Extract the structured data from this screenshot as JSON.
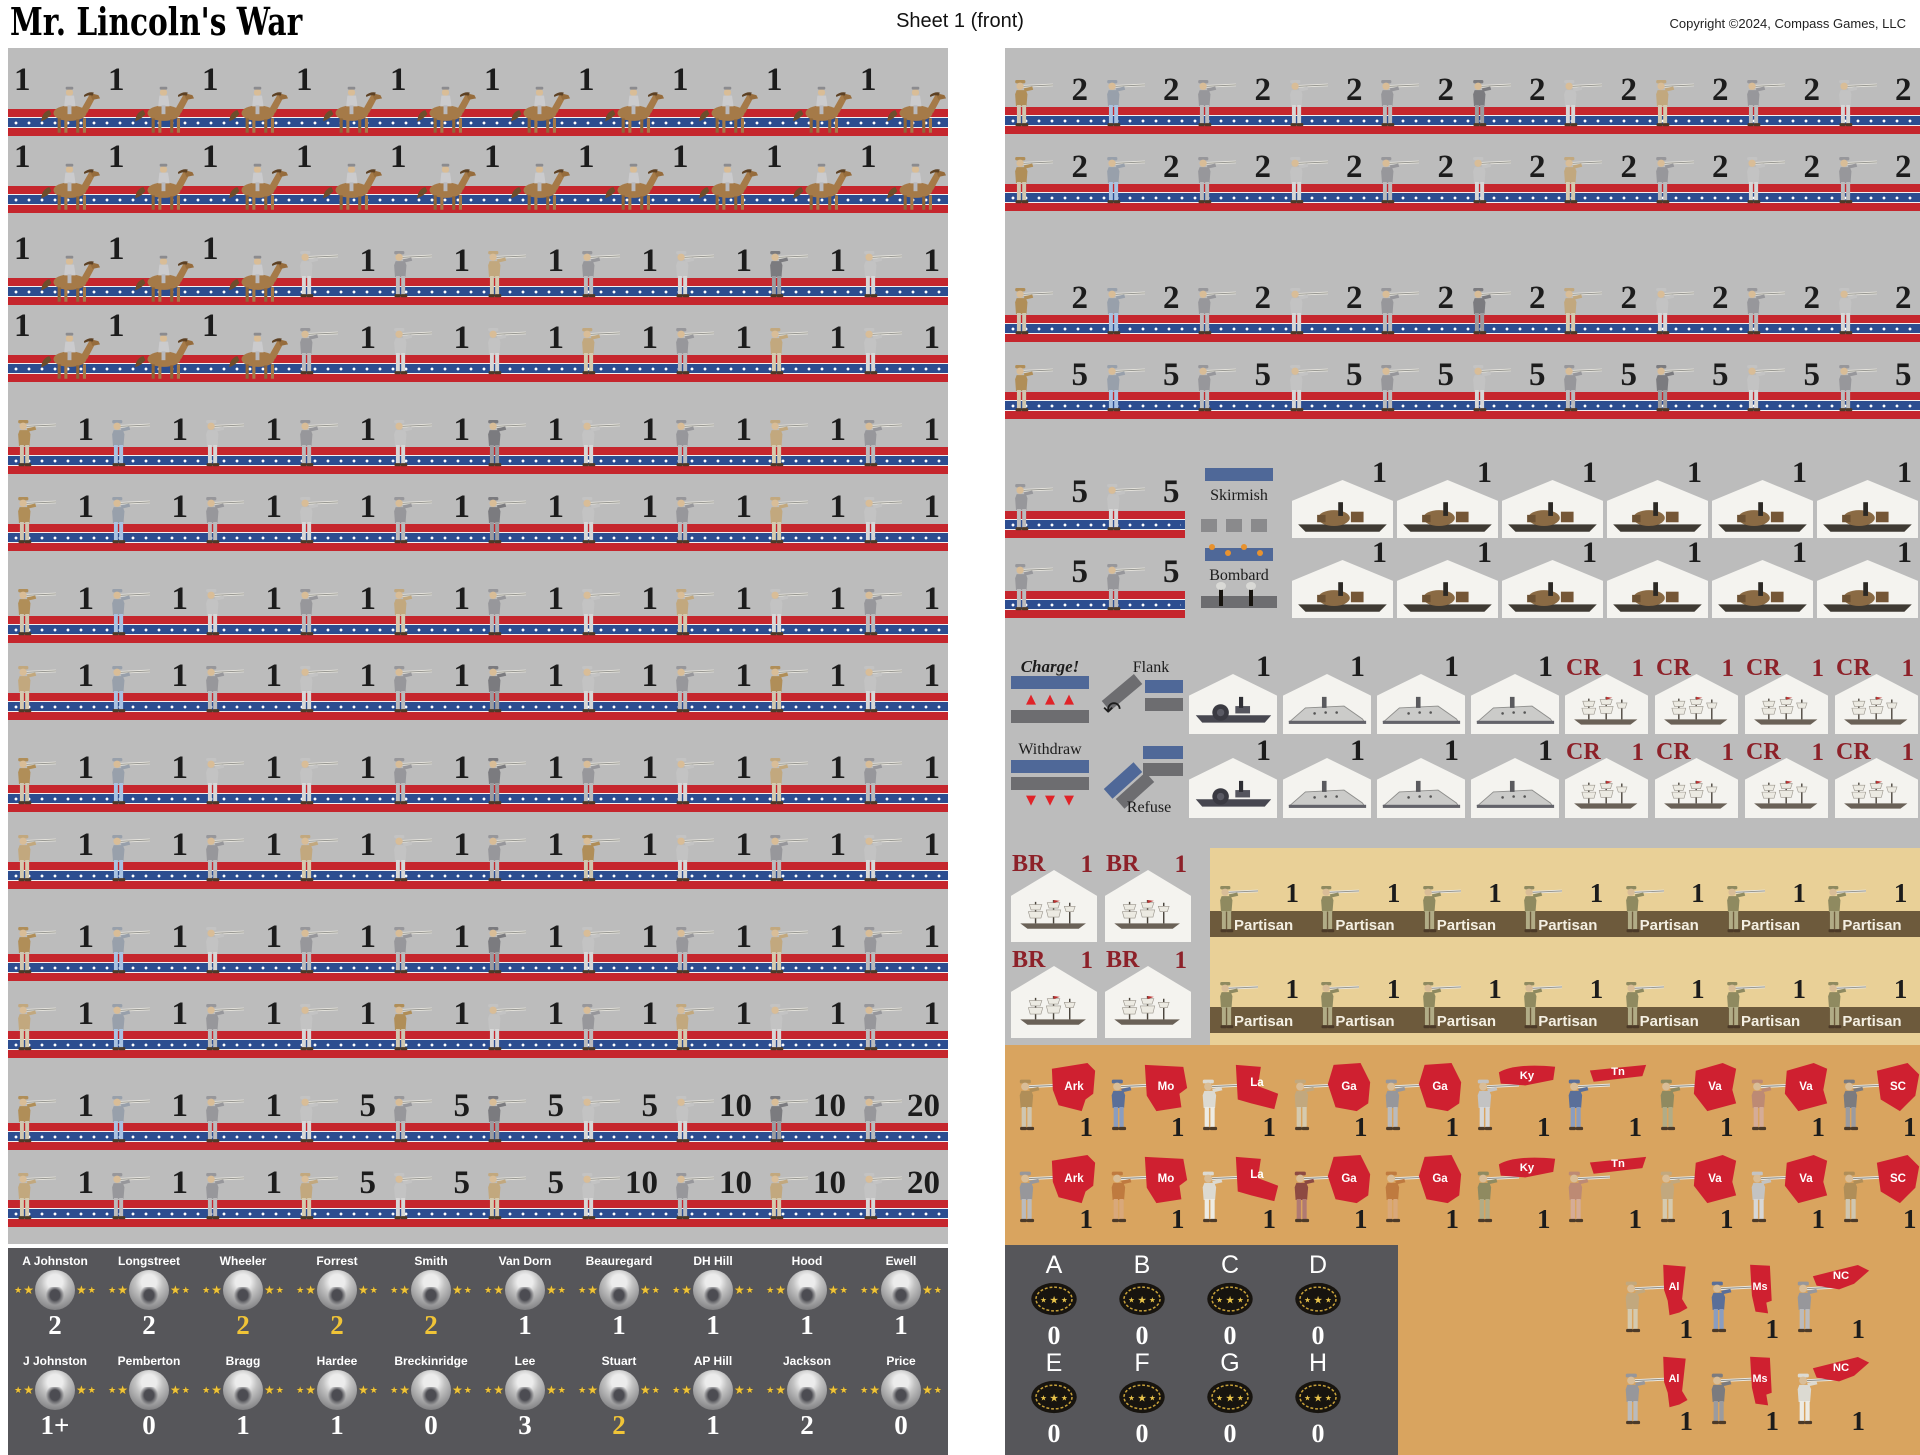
{
  "header": {
    "title": "Mr. Lincoln's War",
    "sheet_label": "Sheet 1 (front)",
    "copyright": "Copyright ©2024, Compass Games, LLC"
  },
  "colors": {
    "panel_gray": "#bcbcbc",
    "dark_panel": "#56565a",
    "orange_panel": "#d9a45f",
    "partisan_panel": "#e9d097",
    "stripe_red": "#c5262d",
    "stripe_blue": "#2c4d90",
    "maroon": "#8d2129",
    "gold_star": "#f0c437",
    "partisan_band": "#6d5a3c",
    "state_red": "#cf2030"
  },
  "labels": {
    "skirmish": "Skirmish",
    "bombard": "Bombard",
    "charge": "Charge!",
    "flank": "Flank",
    "withdraw": "Withdraw",
    "refuse": "Refuse",
    "partisan": "Partisan",
    "cr": "CR",
    "br": "BR"
  },
  "left_panel": {
    "rows": [
      {
        "kind": "cavalry",
        "values": [
          "1",
          "1",
          "1",
          "1",
          "1",
          "1",
          "1",
          "1",
          "1",
          "1"
        ],
        "uniforms": []
      },
      {
        "kind": "cavalry",
        "values": [
          "1",
          "1",
          "1",
          "1",
          "1",
          "1",
          "1",
          "1",
          "1",
          "1"
        ],
        "uniforms": []
      },
      {
        "kind": "mixed",
        "values": [
          "1",
          "1",
          "1",
          "1",
          "1",
          "1",
          "1",
          "1",
          "1",
          "1"
        ],
        "uniforms": [
          "l",
          "g",
          "u",
          "g",
          "l",
          "d",
          "l"
        ]
      },
      {
        "kind": "mixed",
        "values": [
          "1",
          "1",
          "1",
          "1",
          "1",
          "1",
          "1",
          "1",
          "1",
          "1"
        ],
        "uniforms": [
          "g",
          "l",
          "l",
          "u",
          "g",
          "u",
          "l"
        ]
      },
      {
        "kind": "infantry",
        "values": [
          "1",
          "1",
          "1",
          "1",
          "1",
          "1",
          "1",
          "1",
          "1",
          "1"
        ],
        "uniforms": [
          "t",
          "b",
          "l",
          "g",
          "l",
          "d",
          "l",
          "g",
          "u",
          "g"
        ]
      },
      {
        "kind": "infantry",
        "values": [
          "1",
          "1",
          "1",
          "1",
          "1",
          "1",
          "1",
          "1",
          "1",
          "1"
        ],
        "uniforms": [
          "t",
          "b",
          "g",
          "l",
          "g",
          "d",
          "l",
          "g",
          "u",
          "l"
        ]
      },
      {
        "kind": "infantry",
        "values": [
          "1",
          "1",
          "1",
          "1",
          "1",
          "1",
          "1",
          "1",
          "1",
          "1"
        ],
        "uniforms": [
          "t",
          "b",
          "l",
          "g",
          "u",
          "g",
          "l",
          "u",
          "l",
          "g"
        ]
      },
      {
        "kind": "infantry",
        "values": [
          "1",
          "1",
          "1",
          "1",
          "1",
          "1",
          "1",
          "1",
          "1",
          "1"
        ],
        "uniforms": [
          "u",
          "b",
          "g",
          "l",
          "g",
          "d",
          "l",
          "g",
          "t",
          "l"
        ]
      },
      {
        "kind": "infantry",
        "values": [
          "1",
          "1",
          "1",
          "1",
          "1",
          "1",
          "1",
          "1",
          "1",
          "1"
        ],
        "uniforms": [
          "t",
          "b",
          "l",
          "l",
          "g",
          "d",
          "g",
          "l",
          "u",
          "g"
        ]
      },
      {
        "kind": "infantry",
        "values": [
          "1",
          "1",
          "1",
          "1",
          "1",
          "1",
          "1",
          "1",
          "1",
          "1"
        ],
        "uniforms": [
          "u",
          "b",
          "g",
          "u",
          "l",
          "g",
          "t",
          "l",
          "g",
          "l"
        ]
      },
      {
        "kind": "infantry",
        "values": [
          "1",
          "1",
          "1",
          "1",
          "1",
          "1",
          "1",
          "1",
          "1",
          "1"
        ],
        "uniforms": [
          "t",
          "b",
          "l",
          "g",
          "g",
          "d",
          "l",
          "g",
          "u",
          "g"
        ]
      },
      {
        "kind": "infantry",
        "values": [
          "1",
          "1",
          "1",
          "1",
          "1",
          "1",
          "1",
          "1",
          "1",
          "1"
        ],
        "uniforms": [
          "u",
          "b",
          "g",
          "l",
          "t",
          "l",
          "g",
          "u",
          "l",
          "g"
        ]
      },
      {
        "kind": "infantry",
        "values": [
          "1",
          "1",
          "1",
          "5",
          "5",
          "5",
          "5",
          "10",
          "10",
          "20"
        ],
        "uniforms": [
          "t",
          "b",
          "g",
          "l",
          "g",
          "d",
          "l",
          "l",
          "d",
          "g"
        ]
      },
      {
        "kind": "infantry",
        "values": [
          "1",
          "1",
          "1",
          "5",
          "5",
          "5",
          "10",
          "10",
          "10",
          "20"
        ],
        "uniforms": [
          "u",
          "g",
          "g",
          "u",
          "l",
          "u",
          "l",
          "g",
          "u",
          "l"
        ]
      }
    ]
  },
  "leaders": {
    "rows": [
      [
        {
          "name": "A Johnston",
          "value": "2",
          "gold": false
        },
        {
          "name": "Longstreet",
          "value": "2",
          "gold": false
        },
        {
          "name": "Wheeler",
          "value": "2",
          "gold": true
        },
        {
          "name": "Forrest",
          "value": "2",
          "gold": true
        },
        {
          "name": "Smith",
          "value": "2",
          "gold": true
        },
        {
          "name": "Van Dorn",
          "value": "1",
          "gold": false
        },
        {
          "name": "Beauregard",
          "value": "1",
          "gold": false
        },
        {
          "name": "DH Hill",
          "value": "1",
          "gold": false
        },
        {
          "name": "Hood",
          "value": "1",
          "gold": false
        },
        {
          "name": "Ewell",
          "value": "1",
          "gold": false
        }
      ],
      [
        {
          "name": "J Johnston",
          "value": "1+",
          "gold": false
        },
        {
          "name": "Pemberton",
          "value": "0",
          "gold": false
        },
        {
          "name": "Bragg",
          "value": "1",
          "gold": false
        },
        {
          "name": "Hardee",
          "value": "1",
          "gold": false
        },
        {
          "name": "Breckinridge",
          "value": "0",
          "gold": false
        },
        {
          "name": "Lee",
          "value": "3",
          "gold": false
        },
        {
          "name": "Stuart",
          "value": "2",
          "gold": true
        },
        {
          "name": "AP Hill",
          "value": "1",
          "gold": false
        },
        {
          "name": "Jackson",
          "value": "2",
          "gold": false
        },
        {
          "name": "Price",
          "value": "0",
          "gold": false
        }
      ]
    ]
  },
  "right_panel": {
    "infantry_rows": [
      {
        "values": [
          "2",
          "2",
          "2",
          "2",
          "2",
          "2",
          "2",
          "2",
          "2",
          "2"
        ],
        "uniforms": [
          "t",
          "b",
          "g",
          "l",
          "g",
          "d",
          "l",
          "u",
          "g",
          "l"
        ]
      },
      {
        "values": [
          "2",
          "2",
          "2",
          "2",
          "2",
          "2",
          "2",
          "2",
          "2",
          "2"
        ],
        "uniforms": [
          "t",
          "b",
          "g",
          "l",
          "g",
          "l",
          "u",
          "g",
          "l",
          "g"
        ]
      },
      {
        "values": [
          "2",
          "2",
          "2",
          "2",
          "2",
          "2",
          "2",
          "2",
          "2",
          "2"
        ],
        "uniforms": [
          "t",
          "b",
          "g",
          "l",
          "g",
          "d",
          "u",
          "l",
          "g",
          "l"
        ]
      },
      {
        "values": [
          "5",
          "5",
          "5",
          "5",
          "5",
          "5",
          "5",
          "5",
          "5",
          "5"
        ],
        "uniforms": [
          "t",
          "b",
          "g",
          "l",
          "g",
          "l",
          "g",
          "d",
          "l",
          "g"
        ]
      }
    ],
    "gunboat_rows": [
      {
        "infantry_values": [
          "5",
          "5"
        ],
        "infantry_uniforms": [
          "g",
          "l"
        ],
        "tactic": "skirmish",
        "boat_values": [
          "1",
          "1",
          "1",
          "1",
          "1",
          "1"
        ]
      },
      {
        "infantry_values": [
          "5",
          "5"
        ],
        "infantry_uniforms": [
          "g",
          "g"
        ],
        "tactic": "bombard",
        "boat_values": [
          "1",
          "1",
          "1",
          "1",
          "1",
          "1"
        ]
      }
    ],
    "navy_rows": [
      {
        "tactics": [
          "charge",
          "flank"
        ],
        "ship_types": [
          "steamer",
          "ironclad",
          "ironclad",
          "ironclad"
        ],
        "ship_values": [
          "1",
          "1",
          "1",
          "1"
        ],
        "cr_values": [
          "1",
          "1",
          "1",
          "1"
        ]
      },
      {
        "tactics": [
          "withdraw",
          "refuse"
        ],
        "ship_types": [
          "steamer",
          "ironclad",
          "ironclad",
          "ironclad"
        ],
        "ship_values": [
          "1",
          "1",
          "1",
          "1"
        ],
        "cr_values": [
          "1",
          "1",
          "1",
          "1"
        ]
      }
    ],
    "br_values": [
      "1",
      "1",
      "1",
      "1"
    ],
    "partisan_rows": [
      [
        "1",
        "1",
        "1",
        "1",
        "1",
        "1",
        "1"
      ],
      [
        "1",
        "1",
        "1",
        "1",
        "1",
        "1",
        "1"
      ]
    ]
  },
  "states_panel": {
    "rows": [
      {
        "abbrs": [
          "Ark",
          "Mo",
          "La",
          "Ga",
          "Ga",
          "Ky",
          "Tn",
          "Va",
          "Va",
          "SC"
        ],
        "values": [
          "1",
          "1",
          "1",
          "1",
          "1",
          "1",
          "1",
          "1",
          "1",
          "1"
        ],
        "uniforms": [
          "t",
          "n",
          "w",
          "u",
          "g",
          "l",
          "n",
          "v",
          "s",
          "d"
        ]
      },
      {
        "abbrs": [
          "Ark",
          "Mo",
          "La",
          "Ga",
          "Ga",
          "Ky",
          "Tn",
          "Va",
          "Va",
          "SC"
        ],
        "values": [
          "1",
          "1",
          "1",
          "1",
          "1",
          "1",
          "1",
          "1",
          "1",
          "1"
        ],
        "uniforms": [
          "g",
          "o",
          "w",
          "m",
          "o",
          "v",
          "s",
          "u",
          "l",
          "t"
        ]
      }
    ],
    "extra_rows": [
      {
        "abbrs": [
          "Al",
          "Ms",
          "NC"
        ],
        "values": [
          "1",
          "1",
          "1"
        ],
        "uniforms": [
          "u",
          "n",
          "g"
        ]
      },
      {
        "abbrs": [
          "Al",
          "Ms",
          "NC"
        ],
        "values": [
          "1",
          "1",
          "1"
        ],
        "uniforms": [
          "g",
          "d",
          "w"
        ]
      }
    ]
  },
  "command_panel": {
    "rows": [
      {
        "letters": [
          "A",
          "B",
          "C",
          "D"
        ],
        "values": [
          "0",
          "0",
          "0",
          "0"
        ]
      },
      {
        "letters": [
          "E",
          "F",
          "G",
          "H"
        ],
        "values": [
          "0",
          "0",
          "0",
          "0"
        ]
      }
    ]
  }
}
